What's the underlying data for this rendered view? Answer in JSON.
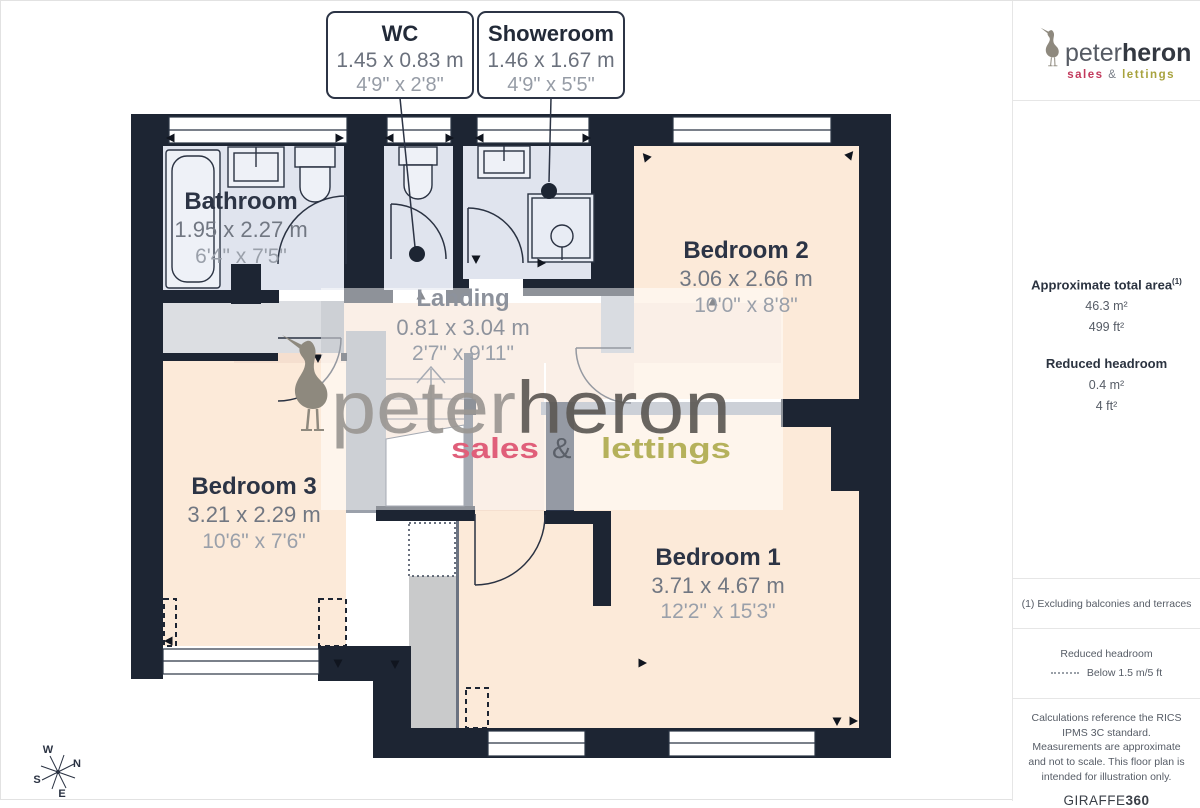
{
  "callouts": {
    "wc": {
      "title": "WC",
      "metric": "1.45 x 0.83 m",
      "imperial": "4'9\" x 2'8\""
    },
    "showeroom": {
      "title": "Showeroom",
      "metric": "1.46 x 1.67 m",
      "imperial": "4'9\" x 5'5\""
    }
  },
  "rooms": {
    "bathroom": {
      "name": "Bathroom",
      "metric": "1.95 x 2.27 m",
      "imperial": "6'4\" x 7'5\""
    },
    "landing": {
      "name": "Landing",
      "metric": "0.81 x 3.04 m",
      "imperial": "2'7\" x 9'11\""
    },
    "bedroom2": {
      "name": "Bedroom 2",
      "metric": "3.06 x 2.66 m",
      "imperial": "10'0\" x 8'8\""
    },
    "bedroom3": {
      "name": "Bedroom 3",
      "metric": "3.21 x 2.29 m",
      "imperial": "10'6\" x 7'6\""
    },
    "bedroom1": {
      "name": "Bedroom 1",
      "metric": "3.71 x 4.67 m",
      "imperial": "12'2\" x 15'3\""
    }
  },
  "watermark": {
    "peter": "peter",
    "heron": "heron",
    "sales": "sales",
    "amp": "&",
    "lettings": "lettings"
  },
  "logo": {
    "peter": "peter",
    "heron": "heron",
    "sales": "sales",
    "amp": "&",
    "lettings": "lettings"
  },
  "sidebar": {
    "area_label": "Approximate total area",
    "area_sup": "(1)",
    "area_m": "46.3 m²",
    "area_ft": "499 ft²",
    "reduced_label": "Reduced headroom",
    "reduced_m": "0.4 m²",
    "reduced_ft": "4 ft²",
    "footnote": "(1) Excluding balconies and terraces",
    "legend_title": "Reduced headroom",
    "legend_value": "Below 1.5 m/5 ft",
    "disclaimer": "Calculations reference the RICS IPMS 3C standard. Measurements are approximate and not to scale. This floor plan is intended for illustration only.",
    "giraffe": "GIRAFFE",
    "g360": "360"
  },
  "compass": {
    "n": "N",
    "e": "E",
    "s": "S",
    "w": "W"
  },
  "colors": {
    "wall": "#1d2533",
    "bath_floor": "#e0e4ee",
    "bed_floor": "#fcead9",
    "landing_floor": "#f5dfcf",
    "brand_pink": "#d94f6e",
    "brand_olive": "#a9a648"
  }
}
